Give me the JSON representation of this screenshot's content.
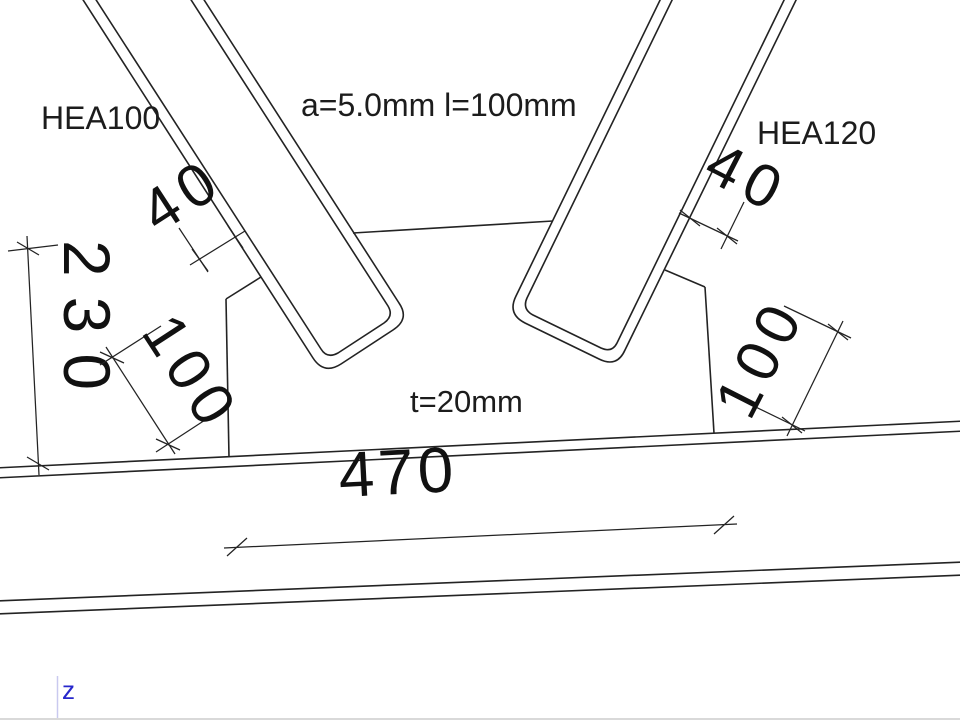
{
  "canvas": {
    "width": 960,
    "height": 720
  },
  "labels": {
    "member_left": "HEA100",
    "member_right": "HEA120",
    "weld": "a=5.0mm l=100mm",
    "plate_thickness": "t=20mm"
  },
  "dimensions": {
    "edge_distance_left": "40",
    "edge_distance_right": "40",
    "plate_height": "230",
    "weld_length_left": "100",
    "weld_length_right": "100",
    "plate_width": "470"
  },
  "axis": {
    "z_label": "z"
  },
  "colors": {
    "line": "#232323",
    "text": "#1c1c1c",
    "axis_z_text": "#2727cc",
    "axis_z_line": "#c9c9ef",
    "background": "#ffffff"
  }
}
